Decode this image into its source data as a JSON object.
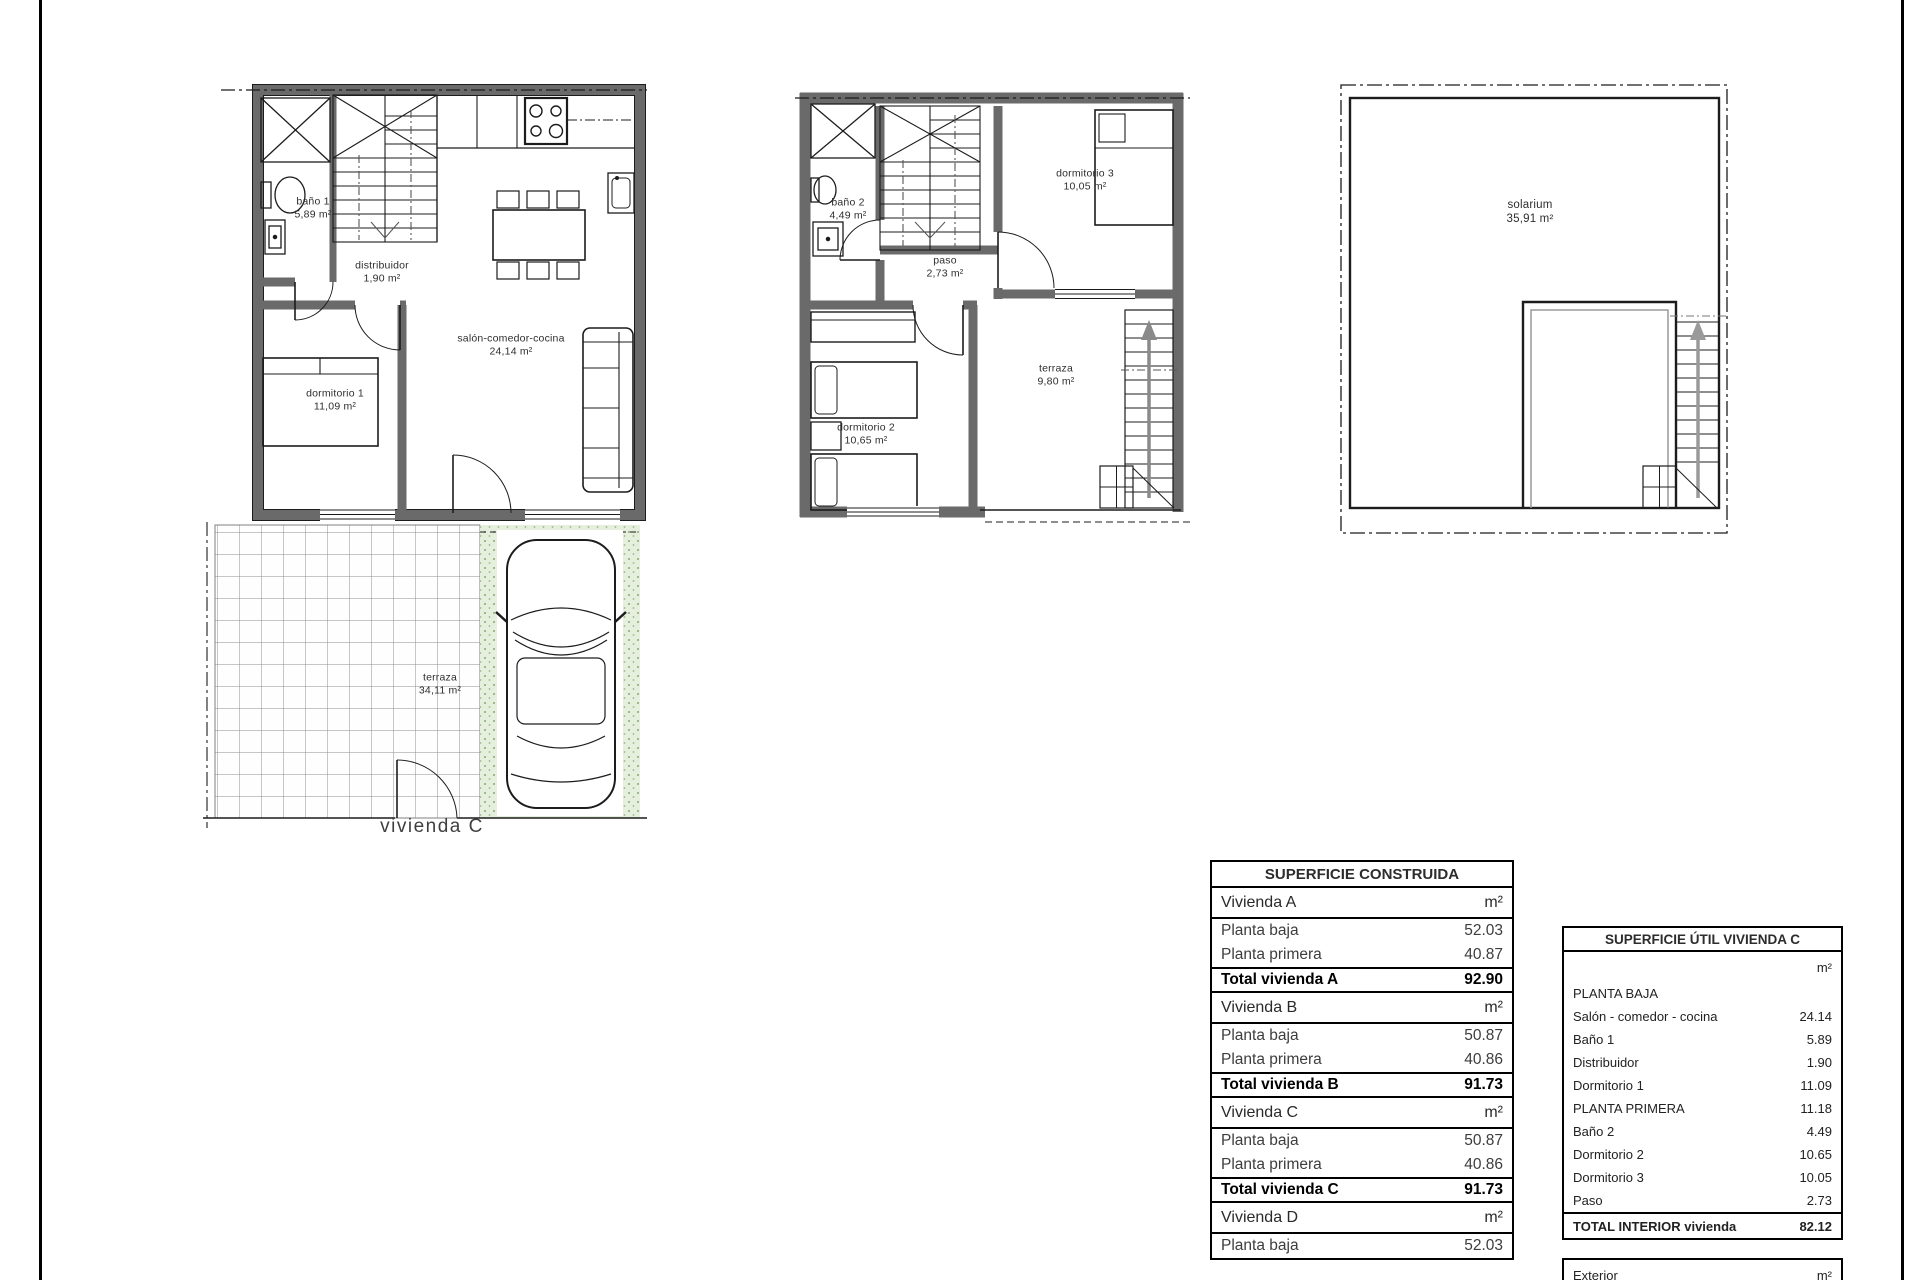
{
  "plans": {
    "ground_floor": {
      "caption": "vivienda C",
      "rooms": {
        "bano1": {
          "name": "baño 1",
          "area": "5,89 m²"
        },
        "distribuidor": {
          "name": "distribuidor",
          "area": "1,90 m²"
        },
        "salon": {
          "name": "salón-comedor-cocina",
          "area": "24,14 m²"
        },
        "dormitorio1": {
          "name": "dormitorio 1",
          "area": "11,09 m²"
        },
        "terraza": {
          "name": "terraza",
          "area": "34,11 m²"
        }
      }
    },
    "first_floor": {
      "rooms": {
        "bano2": {
          "name": "baño 2",
          "area": "4,49 m²"
        },
        "paso": {
          "name": "paso",
          "area": "2,73 m²"
        },
        "dormitorio3": {
          "name": "dormitorio 3",
          "area": "10,05 m²"
        },
        "dormitorio2": {
          "name": "dormitorio 2",
          "area": "10,65 m²"
        },
        "terraza": {
          "name": "terraza",
          "area": "9,80 m²"
        }
      }
    },
    "solarium_floor": {
      "rooms": {
        "solarium": {
          "name": "solarium",
          "area": "35,91 m²"
        }
      }
    }
  },
  "tables": {
    "construida": {
      "title": "SUPERFICIE CONSTRUIDA",
      "rows": [
        {
          "label": "Vivienda A",
          "value": "m²",
          "style": "section"
        },
        {
          "label": "Planta baja",
          "value": "52.03",
          "style": "plain"
        },
        {
          "label": "Planta primera",
          "value": "40.87",
          "style": "plain"
        },
        {
          "label": "Total vivienda A",
          "value": "92.90",
          "style": "total"
        },
        {
          "label": "Vivienda B",
          "value": "m²",
          "style": "section"
        },
        {
          "label": "Planta baja",
          "value": "50.87",
          "style": "plain"
        },
        {
          "label": "Planta primera",
          "value": "40.86",
          "style": "plain"
        },
        {
          "label": "Total vivienda B",
          "value": "91.73",
          "style": "total"
        },
        {
          "label": "Vivienda C",
          "value": "m²",
          "style": "section"
        },
        {
          "label": "Planta baja",
          "value": "50.87",
          "style": "plain"
        },
        {
          "label": "Planta primera",
          "value": "40.86",
          "style": "plain"
        },
        {
          "label": "Total vivienda C",
          "value": "91.73",
          "style": "total"
        },
        {
          "label": "Vivienda D",
          "value": "m²",
          "style": "section"
        },
        {
          "label": "Planta baja",
          "value": "52.03",
          "style": "plain"
        }
      ]
    },
    "util": {
      "title": "SUPERFICIE ÚTIL VIVIENDA C",
      "box1_rows": [
        {
          "label": "",
          "value": "m²",
          "style": "unit"
        },
        {
          "label": "PLANTA BAJA",
          "value": "",
          "style": "plain"
        },
        {
          "label": "Salón - comedor - cocina",
          "value": "24.14",
          "style": "plain"
        },
        {
          "label": "Baño 1",
          "value": "5.89",
          "style": "plain"
        },
        {
          "label": "Distribuidor",
          "value": "1.90",
          "style": "plain"
        },
        {
          "label": "Dormitorio 1",
          "value": "11.09",
          "style": "plain"
        },
        {
          "label": "PLANTA PRIMERA",
          "value": "11.18",
          "style": "plain"
        },
        {
          "label": "Baño 2",
          "value": "4.49",
          "style": "plain"
        },
        {
          "label": "Dormitorio 2",
          "value": "10.65",
          "style": "plain"
        },
        {
          "label": "Dormitorio 3",
          "value": "10.05",
          "style": "plain"
        },
        {
          "label": "Paso",
          "value": "2.73",
          "style": "plain"
        },
        {
          "label": "TOTAL INTERIOR vivienda",
          "value": "82.12",
          "style": "total"
        }
      ],
      "box2_rows": [
        {
          "label": "Exterior",
          "value": "m²",
          "style": "unit"
        },
        {
          "label": "Terraza",
          "value": "34.11",
          "style": "plain"
        }
      ]
    }
  },
  "colors": {
    "wall": "#6a6a6a",
    "line": "#1c1c1c",
    "grass": "#e6eedd",
    "grass_dot": "#8aa86e"
  }
}
